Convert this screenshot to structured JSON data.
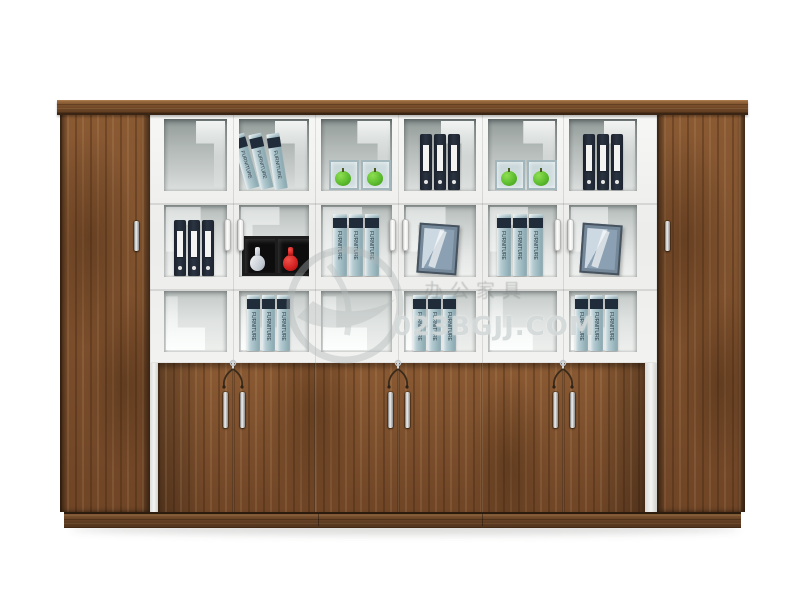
{
  "photo": {
    "type": "furniture-product-photo",
    "subject": "Walnut office wall cabinet with white-framed glass display doors, lower wood cupboards and two full-height side wardrobes",
    "background": "#ffffff"
  },
  "watermark": {
    "site": "023BGJJ.COM",
    "caption_cn": "办公家具",
    "logo": "swoosh-circle"
  },
  "labels": {
    "book_spine": "FURNITURE"
  },
  "palette": {
    "wood": "#7a4e2c",
    "wood_dark": "#4c3019",
    "trim": "#6b4526",
    "frame_white": "#f1f1ef",
    "glass": "#bcc3c1",
    "binder_navy": "#232b38",
    "book_teal": "#a7c0c7",
    "apple_green": "#5cbd2e",
    "vase_red": "#d01f1f",
    "vase_white": "#e3e7ea",
    "metal": "#c9c9c9"
  },
  "inventory": {
    "glass_columns": 6,
    "shelf_rows": 3,
    "row1": [
      "empty",
      "three leaning teal books",
      "two glass cubes with green apples",
      "three navy binders",
      "two glass cubes with green apples",
      "three navy binders"
    ],
    "row2": [
      "three navy binders",
      "white and red vases in black display cubes",
      "three teal books",
      "leaning photo frame",
      "three teal books",
      "leaning photo frame"
    ],
    "row3": [
      "empty",
      "three teal books",
      "empty",
      "three teal books",
      "empty",
      "three teal books"
    ]
  }
}
